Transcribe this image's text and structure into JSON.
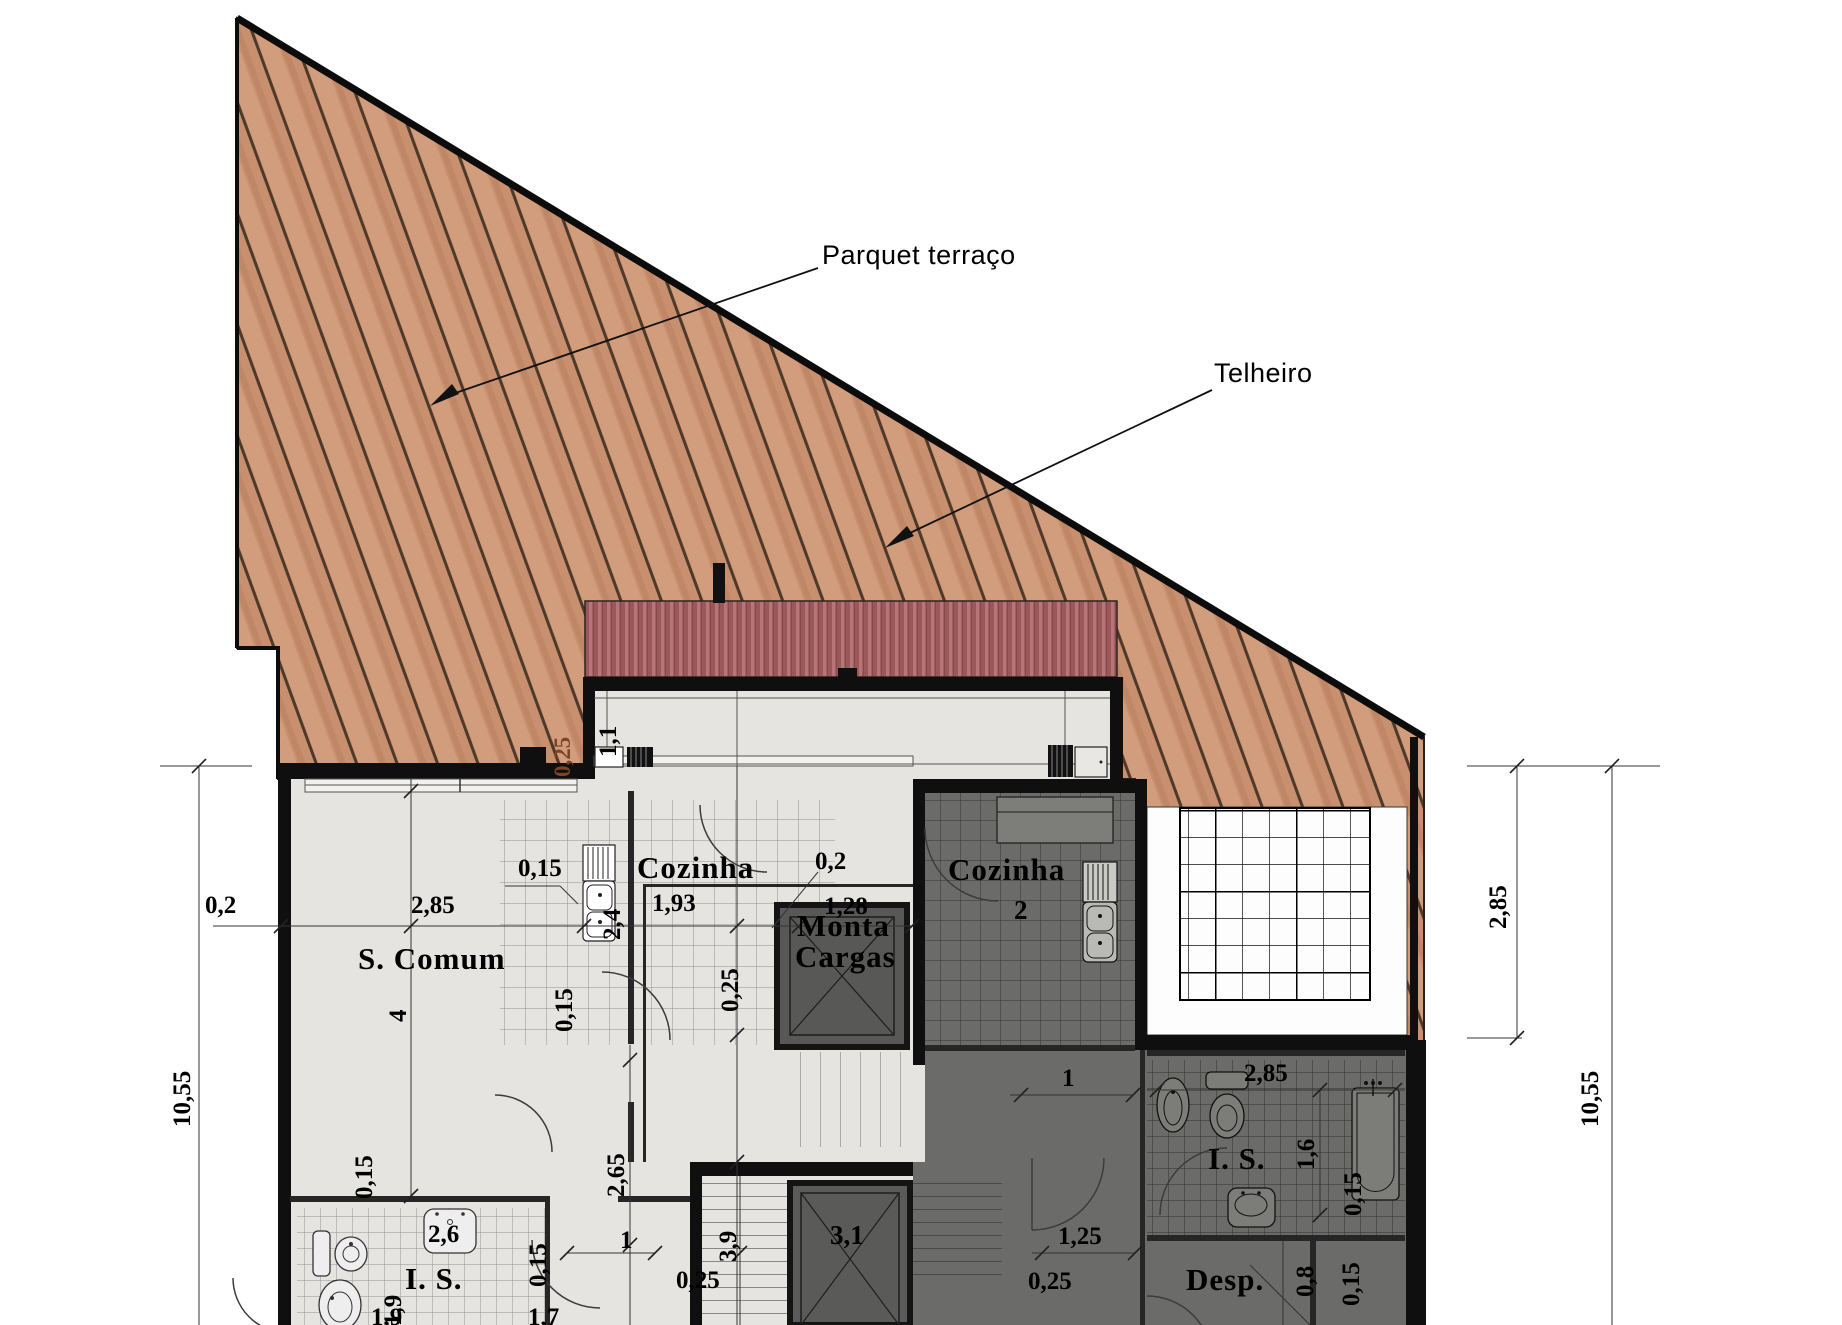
{
  "annotations": {
    "parquet": "Parquet terraço",
    "telheiro": "Telheiro"
  },
  "rooms": {
    "s_comum": "S. Comum",
    "cozinha1": "Cozinha",
    "cozinha2": "Cozinha",
    "cozinha2_num": "2",
    "monta_line1": "Monta",
    "monta_line2": "Cargas",
    "is1": "I. S.",
    "is2": "I. S.",
    "desp": "Desp."
  },
  "dims": {
    "left_offset": "0,2",
    "left_total": "10,55",
    "s_comum_w": "2,85",
    "s_comum_h": "4",
    "wall_015_a": "0,15",
    "kitchen_w": "1,93",
    "kitchen_d": "2,4",
    "kitchen_off": "0,2",
    "monta_w": "1,28",
    "kitchen_wall": "0,15",
    "corridor_wall": "0,25",
    "terrace_h": "1,1",
    "terrace_wall": "0,25",
    "hall_a": "1",
    "corridor_h": "2,65",
    "hall_c": "1",
    "hall_wall": "0,15",
    "basin1": "2,6",
    "bath1_d": "1,9",
    "bath1_wall": "0,15",
    "stair_w": "3,9",
    "stair_wall": "0,25",
    "lift": "3,1",
    "hall2_w": "1,25",
    "hall2_wall": "0,25",
    "bath2_w": "2,85",
    "bath2_d": "1,6",
    "bath2_wall": "0,15",
    "desp_w": "0,8",
    "desp_wall": "0,15",
    "right_upper": "2,85",
    "right_total": "10,55",
    "cut_a": "1,9",
    "cut_b": "1,7"
  }
}
